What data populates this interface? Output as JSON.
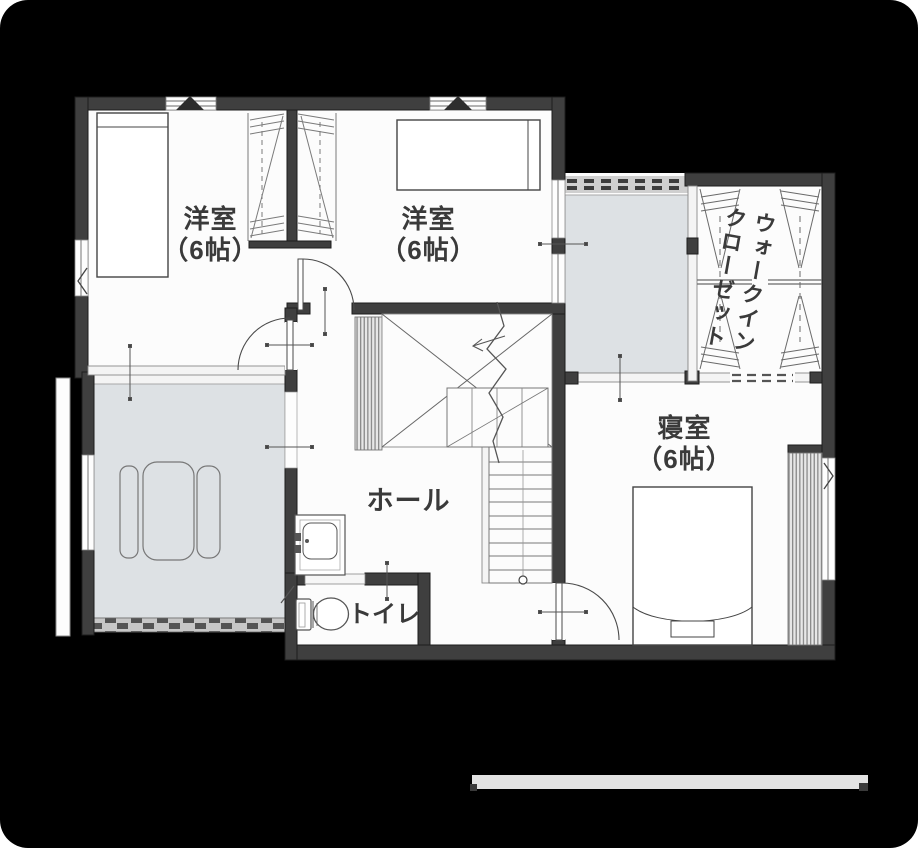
{
  "floor_plan": {
    "rooms": {
      "western_room_1": {
        "label": "洋室",
        "size": "（6帖）"
      },
      "western_room_2": {
        "label": "洋室",
        "size": "（6帖）"
      },
      "bedroom": {
        "label": "寝室",
        "size": "（6帖）"
      },
      "hall": {
        "label": "ホール"
      },
      "toilet": {
        "label": "トイレ"
      },
      "walk_in_closet": {
        "label_line_1": "ウォークイン",
        "label_line_2": "クローゼット"
      }
    },
    "colors": {
      "background": "#000000",
      "floor": "#fcfcfc",
      "wall": "#3f3f3f",
      "balcony_fill": "#dde1e4",
      "label_text": "#3a3a3a",
      "scale_bar": "#e3e3e3"
    }
  }
}
